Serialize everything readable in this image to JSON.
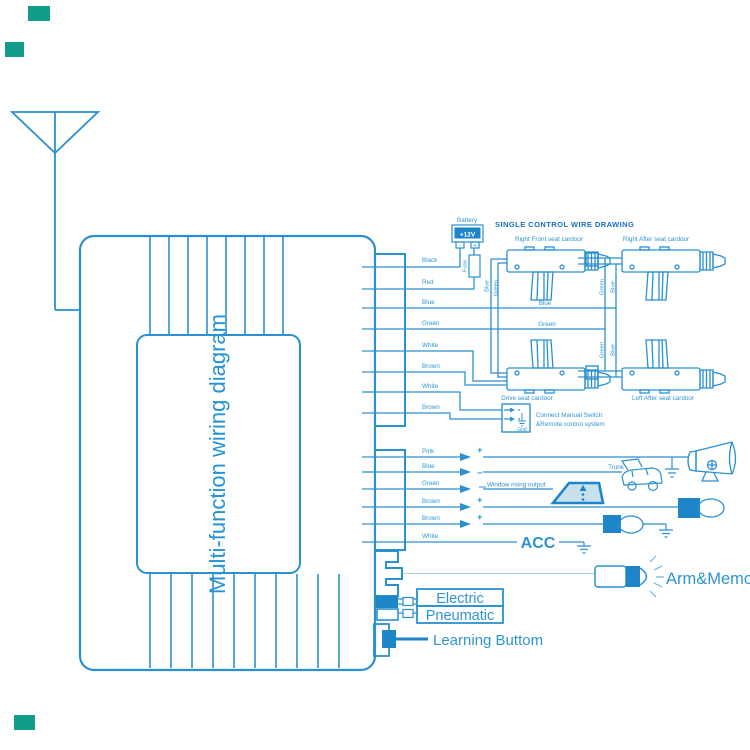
{
  "unit": {
    "title": "Multi-function wiring diagram"
  },
  "section": {
    "title": "SINGLE CONTROL WIRE DRAWING"
  },
  "battery": {
    "label": "Battery",
    "voltage": "+12V",
    "neg": "-",
    "pos": "+",
    "fuse": "Fuse"
  },
  "actuators": {
    "right_front": "Right Front seat cardoor",
    "right_after": "Right After seat cardoor",
    "drive": "Drive seat cardoor",
    "left_after": "Left After seat cardoor"
  },
  "bus": {
    "blue": "Blue",
    "green": "Green"
  },
  "vlabels": {
    "rf_blue": "Blue",
    "rf_green": "Green",
    "ra_green": "Green",
    "ra_blue": "Blue",
    "la_green": "Green",
    "la_blue": "Blue"
  },
  "c1": [
    "Black",
    "Red",
    "Blue",
    "Green",
    "White",
    "Brown",
    "White",
    "Brown"
  ],
  "c2": [
    "Pink",
    "Blue",
    "Green",
    "Brown",
    "Brown",
    "White"
  ],
  "signs": {
    "pink": "+",
    "blue": "−",
    "brown1": "+",
    "brown2": "+"
  },
  "ms": {
    "line1": "Connect Manual Switch",
    "line2": "&Remote control system",
    "gnd": "Gnd"
  },
  "notes": {
    "window": "Window rising output",
    "trunk": "Trunk",
    "acc": "ACC",
    "arm": "Arm&Memory",
    "learning": "Learning Buttom"
  },
  "boxes": {
    "electric": "Electric",
    "pneumatic": "Pneumatic"
  },
  "colors": {
    "wire": "#2a90d0",
    "accent_fill": "#1e86c8",
    "section_title": "#1a6ec2",
    "watermark_teal": "#129c8a",
    "window_fill": "#c8dfec"
  }
}
